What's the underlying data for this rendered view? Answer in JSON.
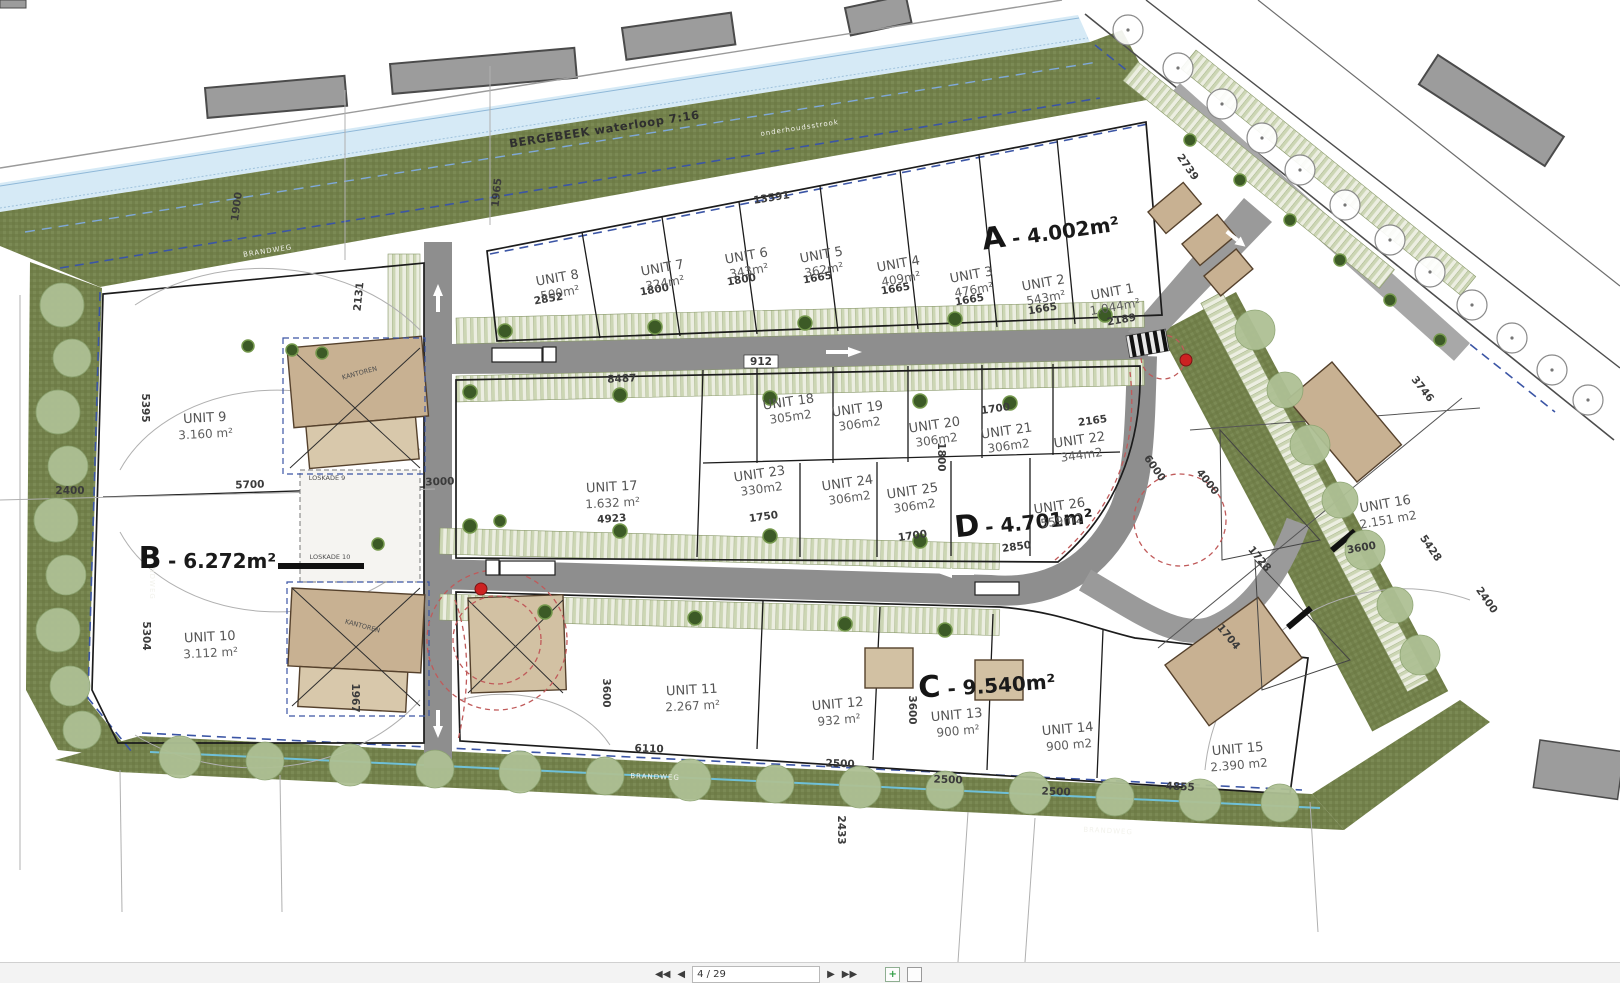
{
  "labels": {
    "stream": "BERGEBEEK waterloop 7:16",
    "maintenance_strip": "onderhoudsstrook",
    "fire_road": "BRANDWEG",
    "loskade_9": "LOSKADE 9",
    "loskade_10": "LOSKADE 10",
    "kantoren": "KANTOREN"
  },
  "zones": [
    {
      "letter": "A",
      "area": "- 4.002m²"
    },
    {
      "letter": "B",
      "area": "- 6.272m²"
    },
    {
      "letter": "C",
      "area": "- 9.540m²"
    },
    {
      "letter": "D",
      "area": "- 4.701m²"
    }
  ],
  "units": [
    {
      "name": "UNIT 1",
      "area": "1.044m²"
    },
    {
      "name": "UNIT 2",
      "area": "543m²"
    },
    {
      "name": "UNIT 3",
      "area": "476m²"
    },
    {
      "name": "UNIT 4",
      "area": "409m²"
    },
    {
      "name": "UNIT 5",
      "area": "362m²"
    },
    {
      "name": "UNIT 6",
      "area": "343m²"
    },
    {
      "name": "UNIT 7",
      "area": "324m²"
    },
    {
      "name": "UNIT 8",
      "area": "500m²"
    },
    {
      "name": "UNIT 9",
      "area": "3.160 m²"
    },
    {
      "name": "UNIT 10",
      "area": "3.112 m²"
    },
    {
      "name": "UNIT 11",
      "area": "2.267 m²"
    },
    {
      "name": "UNIT 12",
      "area": "932 m²"
    },
    {
      "name": "UNIT 13",
      "area": "900 m²"
    },
    {
      "name": "UNIT 14",
      "area": "900 m2"
    },
    {
      "name": "UNIT 15",
      "area": "2.390 m2"
    },
    {
      "name": "UNIT 16",
      "area": "2.151 m2"
    },
    {
      "name": "UNIT 17",
      "area": "1.632 m²"
    },
    {
      "name": "UNIT 18",
      "area": "305m2"
    },
    {
      "name": "UNIT 19",
      "area": "306m2"
    },
    {
      "name": "UNIT 20",
      "area": "306m2"
    },
    {
      "name": "UNIT 21",
      "area": "306m2"
    },
    {
      "name": "UNIT 22",
      "area": "344m2"
    },
    {
      "name": "UNIT 23",
      "area": "330m2"
    },
    {
      "name": "UNIT 24",
      "area": "306m2"
    },
    {
      "name": "UNIT 25",
      "area": "306m2"
    },
    {
      "name": "UNIT 26",
      "area": "559m2"
    }
  ],
  "dims": [
    "1900",
    "1965",
    "13591",
    "2852",
    "1800",
    "1800",
    "1665",
    "1665",
    "1665",
    "1665",
    "2189",
    "912",
    "8487",
    "1700",
    "2165",
    "6000",
    "4000",
    "1750",
    "1700",
    "1800",
    "2850",
    "4923",
    "5700",
    "3000",
    "2400",
    "5395",
    "5304",
    "6110",
    "2500",
    "2500",
    "2500",
    "1967",
    "3600",
    "3600",
    "2433",
    "4855",
    "3600",
    "5428",
    "2400",
    "1728",
    "1704",
    "3746",
    "2131",
    "2739"
  ],
  "toolbar": {
    "first_glyph": "◀◀",
    "prev_glyph": "◀",
    "page_indicator": "4 / 29",
    "next_glyph": "▶",
    "last_glyph": "▶▶",
    "export_glyph": "+"
  },
  "colors": {
    "buffer_green": "#72804b",
    "stream_blue": "#d6eaf6",
    "road_gray": "#8e8e8e",
    "building_tan": "#c8b192",
    "boundary_blue": "#3b55a5",
    "alert_red": "#cc2222"
  }
}
